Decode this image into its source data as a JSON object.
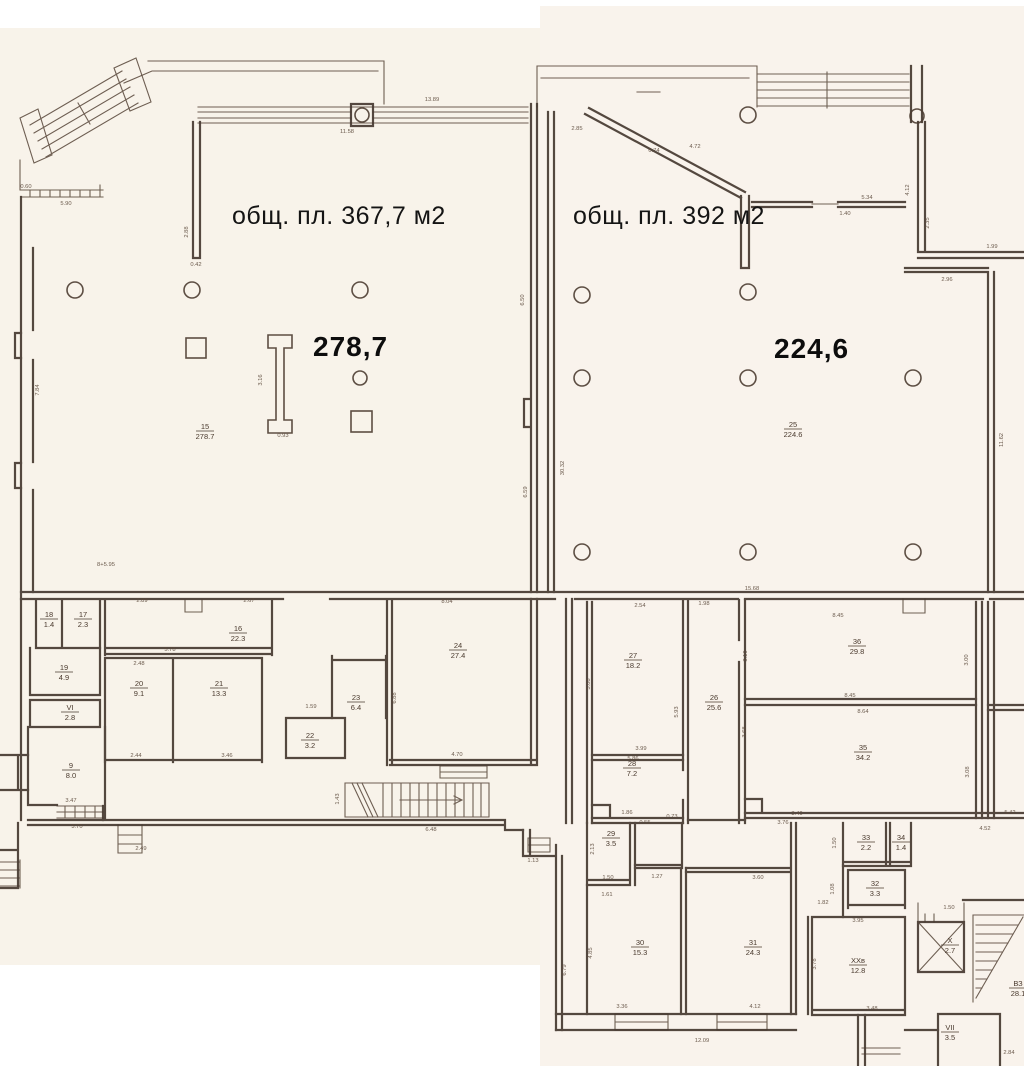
{
  "document": {
    "kind": "scanned floor plan",
    "language": "ru"
  },
  "plan": {
    "colors": {
      "paper": "#f8f3ea",
      "ink": "#473a31",
      "label_text": "#141414"
    },
    "left_room": {
      "area_label": "общ. пл. 367,7 м2",
      "big_number": "278,7",
      "room_number": "15",
      "room_area": "278.7"
    },
    "right_room": {
      "area_label": "общ. пл. 392 м2",
      "big_number": "224,6",
      "room_number": "25",
      "room_area": "224.6"
    },
    "rooms": [
      {
        "n": "15",
        "a": "278.7",
        "x": 205,
        "y": 431
      },
      {
        "n": "25",
        "a": "224.6",
        "x": 793,
        "y": 429
      },
      {
        "n": "18",
        "a": "1.4",
        "x": 49,
        "y": 619
      },
      {
        "n": "17",
        "a": "2.3",
        "x": 83,
        "y": 619
      },
      {
        "n": "16",
        "a": "22.3",
        "x": 238,
        "y": 633
      },
      {
        "n": "19",
        "a": "4.9",
        "x": 64,
        "y": 672
      },
      {
        "n": "VI",
        "a": "2.8",
        "x": 70,
        "y": 712
      },
      {
        "n": "20",
        "a": "9.1",
        "x": 139,
        "y": 688
      },
      {
        "n": "21",
        "a": "13.3",
        "x": 219,
        "y": 688
      },
      {
        "n": "9",
        "a": "8.0",
        "x": 71,
        "y": 770
      },
      {
        "n": "22",
        "a": "3.2",
        "x": 310,
        "y": 740
      },
      {
        "n": "23",
        "a": "6.4",
        "x": 356,
        "y": 702
      },
      {
        "n": "24",
        "a": "27.4",
        "x": 458,
        "y": 650
      },
      {
        "n": "27",
        "a": "18.2",
        "x": 633,
        "y": 660
      },
      {
        "n": "26",
        "a": "25.6",
        "x": 714,
        "y": 702
      },
      {
        "n": "28",
        "a": "7.2",
        "x": 632,
        "y": 768
      },
      {
        "n": "36",
        "a": "29.8",
        "x": 857,
        "y": 646
      },
      {
        "n": "35",
        "a": "34.2",
        "x": 863,
        "y": 752
      },
      {
        "n": "29",
        "a": "3.5",
        "x": 611,
        "y": 838
      },
      {
        "n": "30",
        "a": "15.3",
        "x": 640,
        "y": 947
      },
      {
        "n": "31",
        "a": "24.3",
        "x": 753,
        "y": 947
      },
      {
        "n": "33",
        "a": "2.2",
        "x": 866,
        "y": 842
      },
      {
        "n": "34",
        "a": "1.4",
        "x": 901,
        "y": 842
      },
      {
        "n": "32",
        "a": "3.3",
        "x": 875,
        "y": 888
      },
      {
        "n": "ХХв",
        "a": "12.8",
        "x": 858,
        "y": 965
      },
      {
        "n": "Х",
        "a": "2.7",
        "x": 950,
        "y": 945
      },
      {
        "n": "VII",
        "a": "3.5",
        "x": 950,
        "y": 1032
      },
      {
        "n": "ВЗ",
        "a": "28.1",
        "x": 1018,
        "y": 988
      }
    ],
    "dimensions": [
      {
        "t": "11.58",
        "x": 347,
        "y": 133
      },
      {
        "t": "13.89",
        "x": 432,
        "y": 101
      },
      {
        "t": "5.90",
        "x": 66,
        "y": 205
      },
      {
        "t": "0.60",
        "x": 26,
        "y": 188
      },
      {
        "t": "2.88",
        "x": 188,
        "y": 232,
        "r": 1
      },
      {
        "t": "0.42",
        "x": 196,
        "y": 266
      },
      {
        "t": "2.85",
        "x": 577,
        "y": 130
      },
      {
        "t": "0.74",
        "x": 654,
        "y": 152
      },
      {
        "t": "4.72",
        "x": 695,
        "y": 148
      },
      {
        "t": "5.34",
        "x": 867,
        "y": 199
      },
      {
        "t": "1.40",
        "x": 845,
        "y": 215
      },
      {
        "t": "4.12",
        "x": 909,
        "y": 190,
        "r": 1
      },
      {
        "t": "2.35",
        "x": 929,
        "y": 223,
        "r": 1
      },
      {
        "t": "1.99",
        "x": 992,
        "y": 248
      },
      {
        "t": "2.96",
        "x": 947,
        "y": 281
      },
      {
        "t": "11.62",
        "x": 1003,
        "y": 440,
        "r": 1
      },
      {
        "t": "6.50",
        "x": 524,
        "y": 300,
        "r": 1
      },
      {
        "t": "6.59",
        "x": 527,
        "y": 492,
        "r": 1
      },
      {
        "t": "30.32",
        "x": 564,
        "y": 468,
        "r": 1
      },
      {
        "t": "7.84",
        "x": 39,
        "y": 390,
        "r": 1
      },
      {
        "t": "8+5.95",
        "x": 106,
        "y": 566
      },
      {
        "t": "0.93",
        "x": 283,
        "y": 437
      },
      {
        "t": "3.16",
        "x": 262,
        "y": 380,
        "r": 1
      },
      {
        "t": "15.68",
        "x": 752,
        "y": 590
      },
      {
        "t": "2.54",
        "x": 640,
        "y": 607
      },
      {
        "t": "1.98",
        "x": 704,
        "y": 605
      },
      {
        "t": "2.89",
        "x": 142,
        "y": 602
      },
      {
        "t": "2.67",
        "x": 249,
        "y": 602
      },
      {
        "t": "5.78",
        "x": 170,
        "y": 651
      },
      {
        "t": "2.48",
        "x": 139,
        "y": 665
      },
      {
        "t": "2.44",
        "x": 136,
        "y": 757
      },
      {
        "t": "3.46",
        "x": 227,
        "y": 757
      },
      {
        "t": "3.47",
        "x": 71,
        "y": 802
      },
      {
        "t": "3.70",
        "x": 77,
        "y": 828
      },
      {
        "t": "2.49",
        "x": 141,
        "y": 850
      },
      {
        "t": "8.04",
        "x": 447,
        "y": 603
      },
      {
        "t": "4.70",
        "x": 457,
        "y": 756
      },
      {
        "t": "6.88",
        "x": 396,
        "y": 698,
        "r": 1
      },
      {
        "t": "1.59",
        "x": 311,
        "y": 708
      },
      {
        "t": "6.48",
        "x": 431,
        "y": 831
      },
      {
        "t": "1.13",
        "x": 533,
        "y": 862
      },
      {
        "t": "1.43",
        "x": 339,
        "y": 799,
        "r": 1
      },
      {
        "t": "3.10",
        "x": 747,
        "y": 656,
        "r": 1
      },
      {
        "t": "8.45",
        "x": 838,
        "y": 617
      },
      {
        "t": "8.45",
        "x": 850,
        "y": 697
      },
      {
        "t": "8.64",
        "x": 863,
        "y": 713
      },
      {
        "t": "3.68",
        "x": 746,
        "y": 732,
        "r": 1
      },
      {
        "t": "3.08",
        "x": 969,
        "y": 772,
        "r": 1
      },
      {
        "t": "3.00",
        "x": 968,
        "y": 660,
        "r": 1
      },
      {
        "t": "3.40",
        "x": 797,
        "y": 815
      },
      {
        "t": "3.76",
        "x": 783,
        "y": 824
      },
      {
        "t": "4.52",
        "x": 985,
        "y": 830
      },
      {
        "t": "5.42",
        "x": 1010,
        "y": 814
      },
      {
        "t": "5.08",
        "x": 590,
        "y": 684,
        "r": 1
      },
      {
        "t": "5.93",
        "x": 678,
        "y": 712,
        "r": 1
      },
      {
        "t": "3.99",
        "x": 641,
        "y": 750
      },
      {
        "t": "5.86",
        "x": 633,
        "y": 760
      },
      {
        "t": "1.86",
        "x": 627,
        "y": 814
      },
      {
        "t": "0.55",
        "x": 645,
        "y": 824
      },
      {
        "t": "0.73",
        "x": 672,
        "y": 818
      },
      {
        "t": "2.13",
        "x": 594,
        "y": 849,
        "r": 1
      },
      {
        "t": "1.50",
        "x": 608,
        "y": 879
      },
      {
        "t": "1.27",
        "x": 657,
        "y": 878
      },
      {
        "t": "1.61",
        "x": 607,
        "y": 896
      },
      {
        "t": "4.85",
        "x": 592,
        "y": 953,
        "r": 1
      },
      {
        "t": "3.36",
        "x": 622,
        "y": 1008
      },
      {
        "t": "3.60",
        "x": 758,
        "y": 879
      },
      {
        "t": "4.12",
        "x": 755,
        "y": 1008
      },
      {
        "t": "12.09",
        "x": 702,
        "y": 1042
      },
      {
        "t": "6.79",
        "x": 566,
        "y": 970,
        "r": 1
      },
      {
        "t": "1.50",
        "x": 836,
        "y": 843,
        "r": 1
      },
      {
        "t": "1.08",
        "x": 834,
        "y": 889,
        "r": 1
      },
      {
        "t": "1.82",
        "x": 823,
        "y": 904
      },
      {
        "t": "3.95",
        "x": 858,
        "y": 922
      },
      {
        "t": "3.48",
        "x": 872,
        "y": 1010
      },
      {
        "t": "3.78",
        "x": 816,
        "y": 964,
        "r": 1
      },
      {
        "t": "1.50",
        "x": 949,
        "y": 909
      },
      {
        "t": "2.84",
        "x": 1009,
        "y": 1054
      }
    ]
  }
}
